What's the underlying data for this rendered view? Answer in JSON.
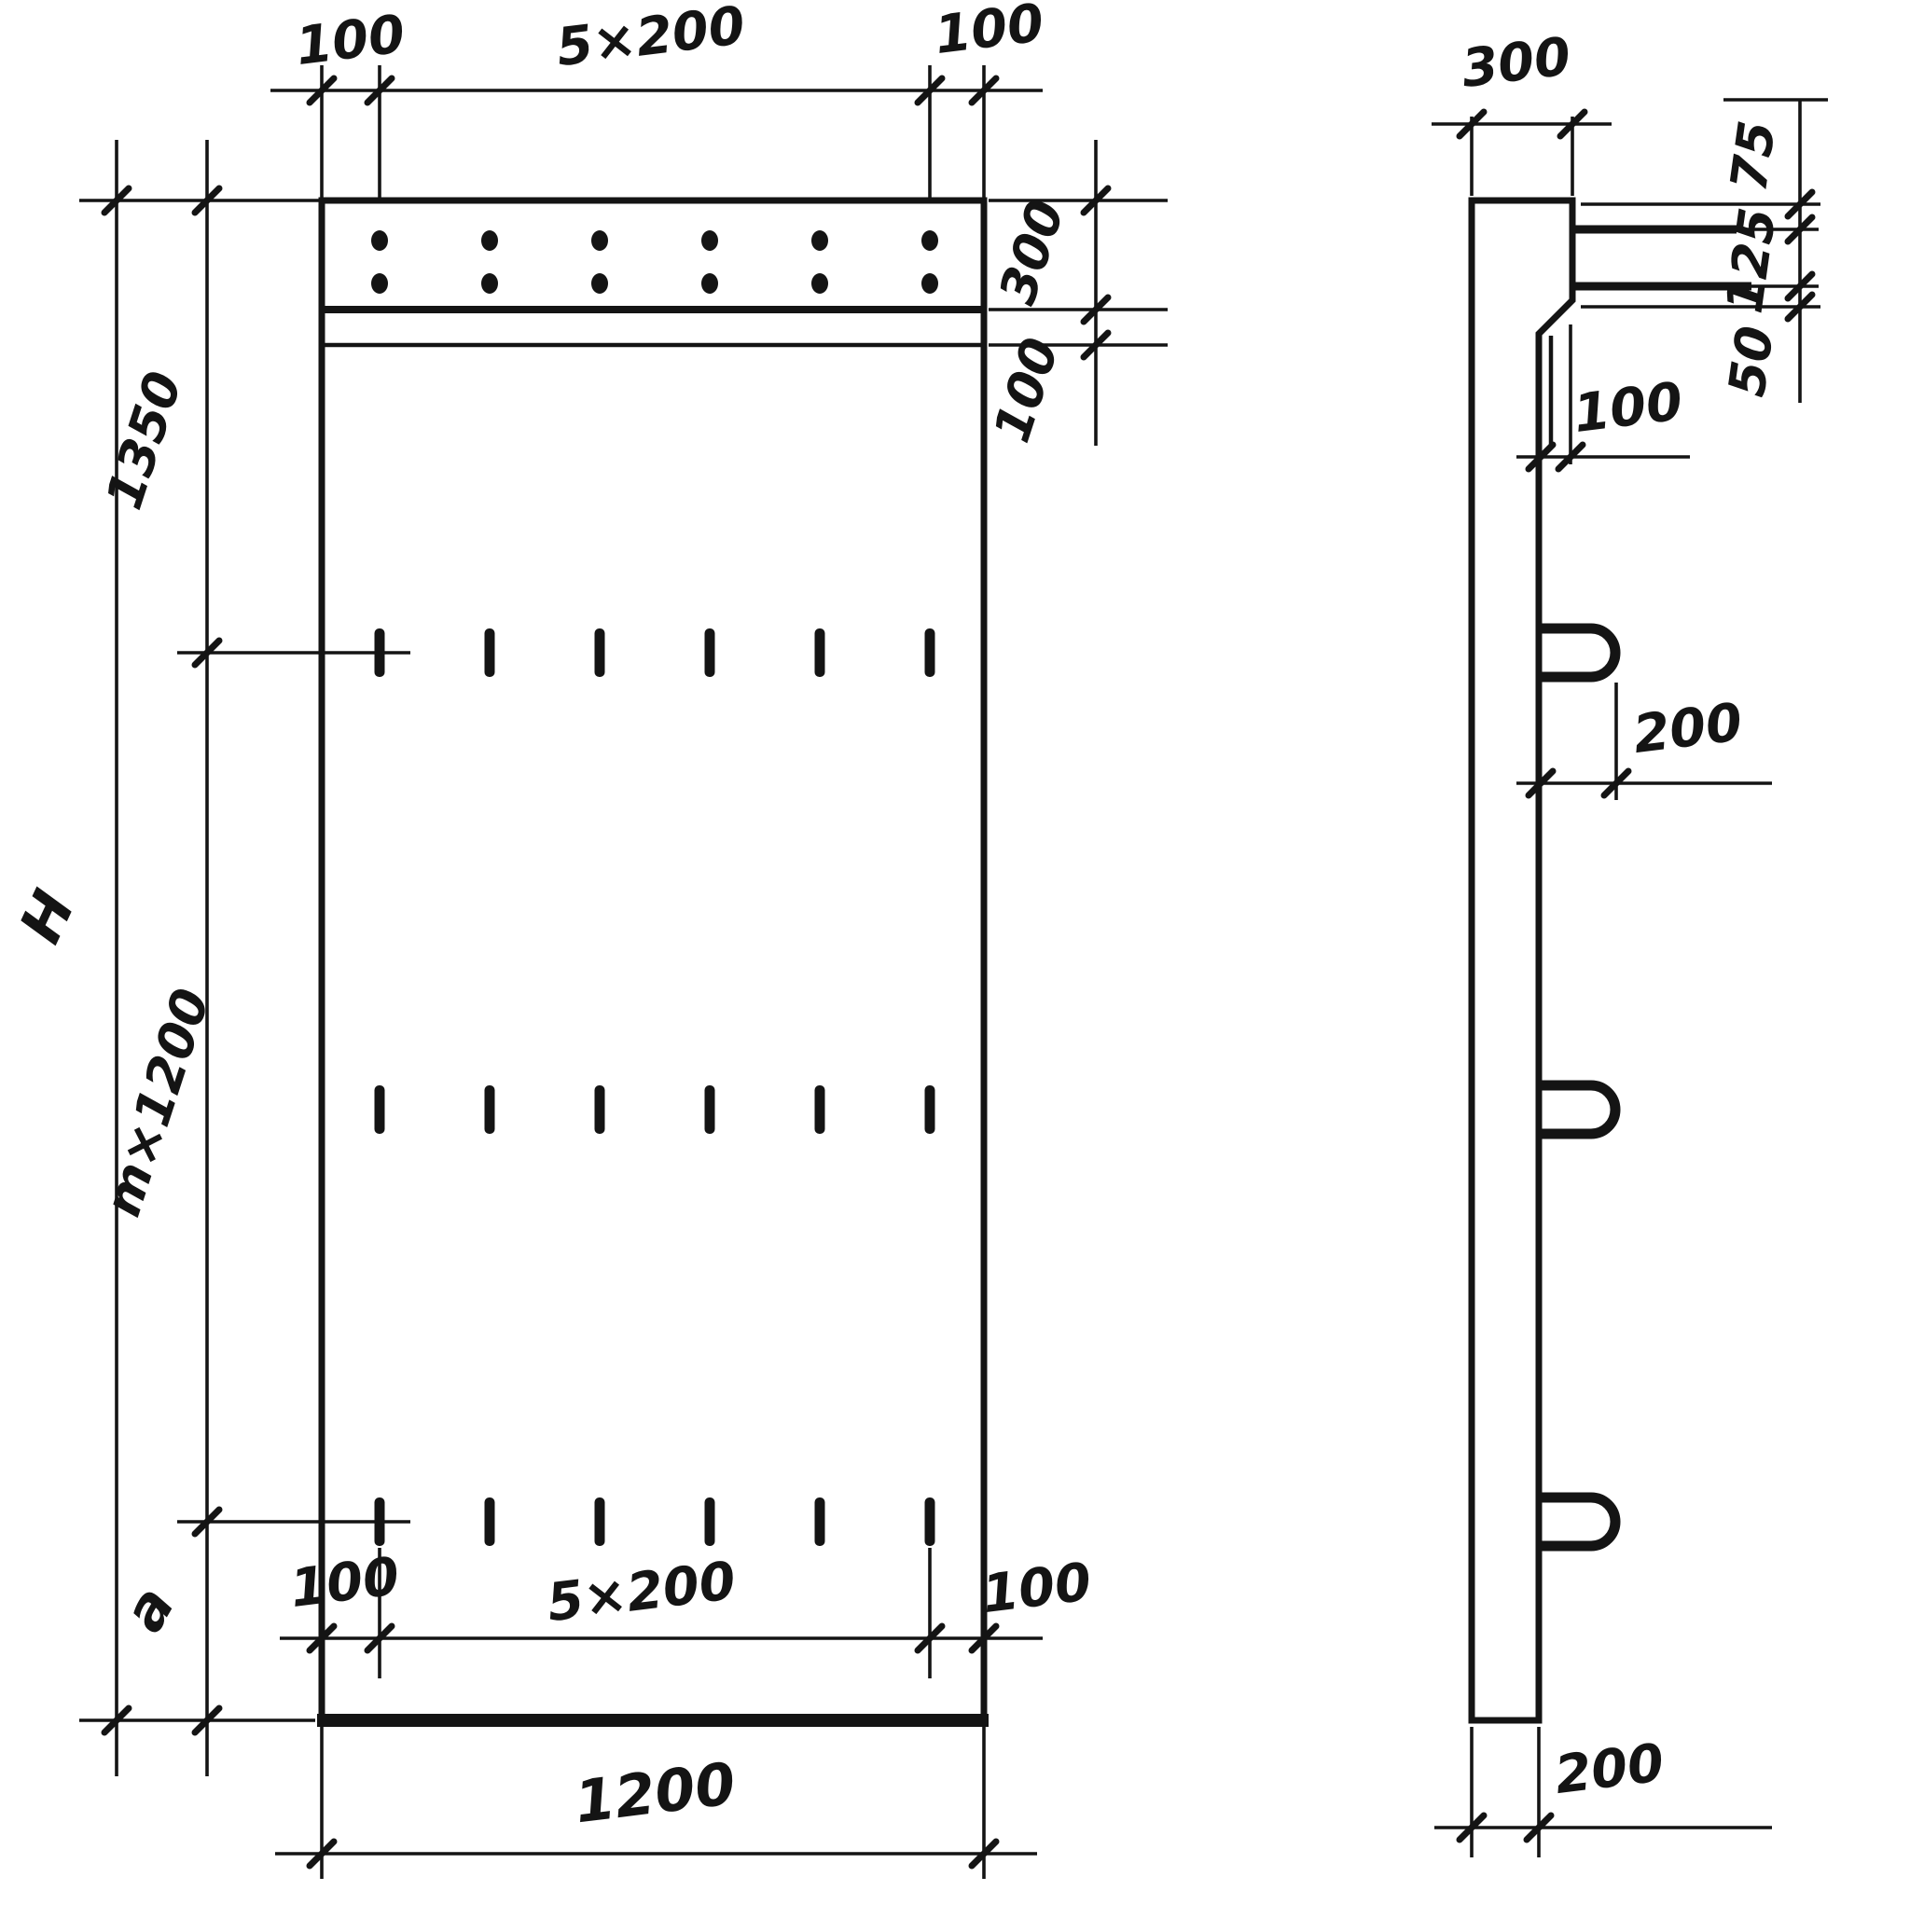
{
  "drawing": {
    "description": "Reinforced concrete wall panel shop drawing, front elevation and side section",
    "ink_color": "#141414",
    "paper_color": "#ffffff"
  },
  "front_view": {
    "top_dimensions": {
      "left_offset": "100",
      "pitch": "5×200",
      "right_offset": "100"
    },
    "band_dimensions": {
      "band_height": "300",
      "groove_offset": "100"
    },
    "left_dimensions": {
      "overall_height": "H",
      "top_zone": "1350",
      "repeat_zone": "m×1200",
      "remainder_zone": "a"
    },
    "bottom_dimensions": {
      "left_offset": "100",
      "pitch": "5×200",
      "right_offset": "100",
      "overall_width": "1200"
    }
  },
  "side_view": {
    "top_thickness": "300",
    "right_dimensions": {
      "upper_offset": "75",
      "middle_offset": "125",
      "lower_offset": "50"
    },
    "hook_offset": "100",
    "loop_projection": "200",
    "base_thickness": "200"
  }
}
